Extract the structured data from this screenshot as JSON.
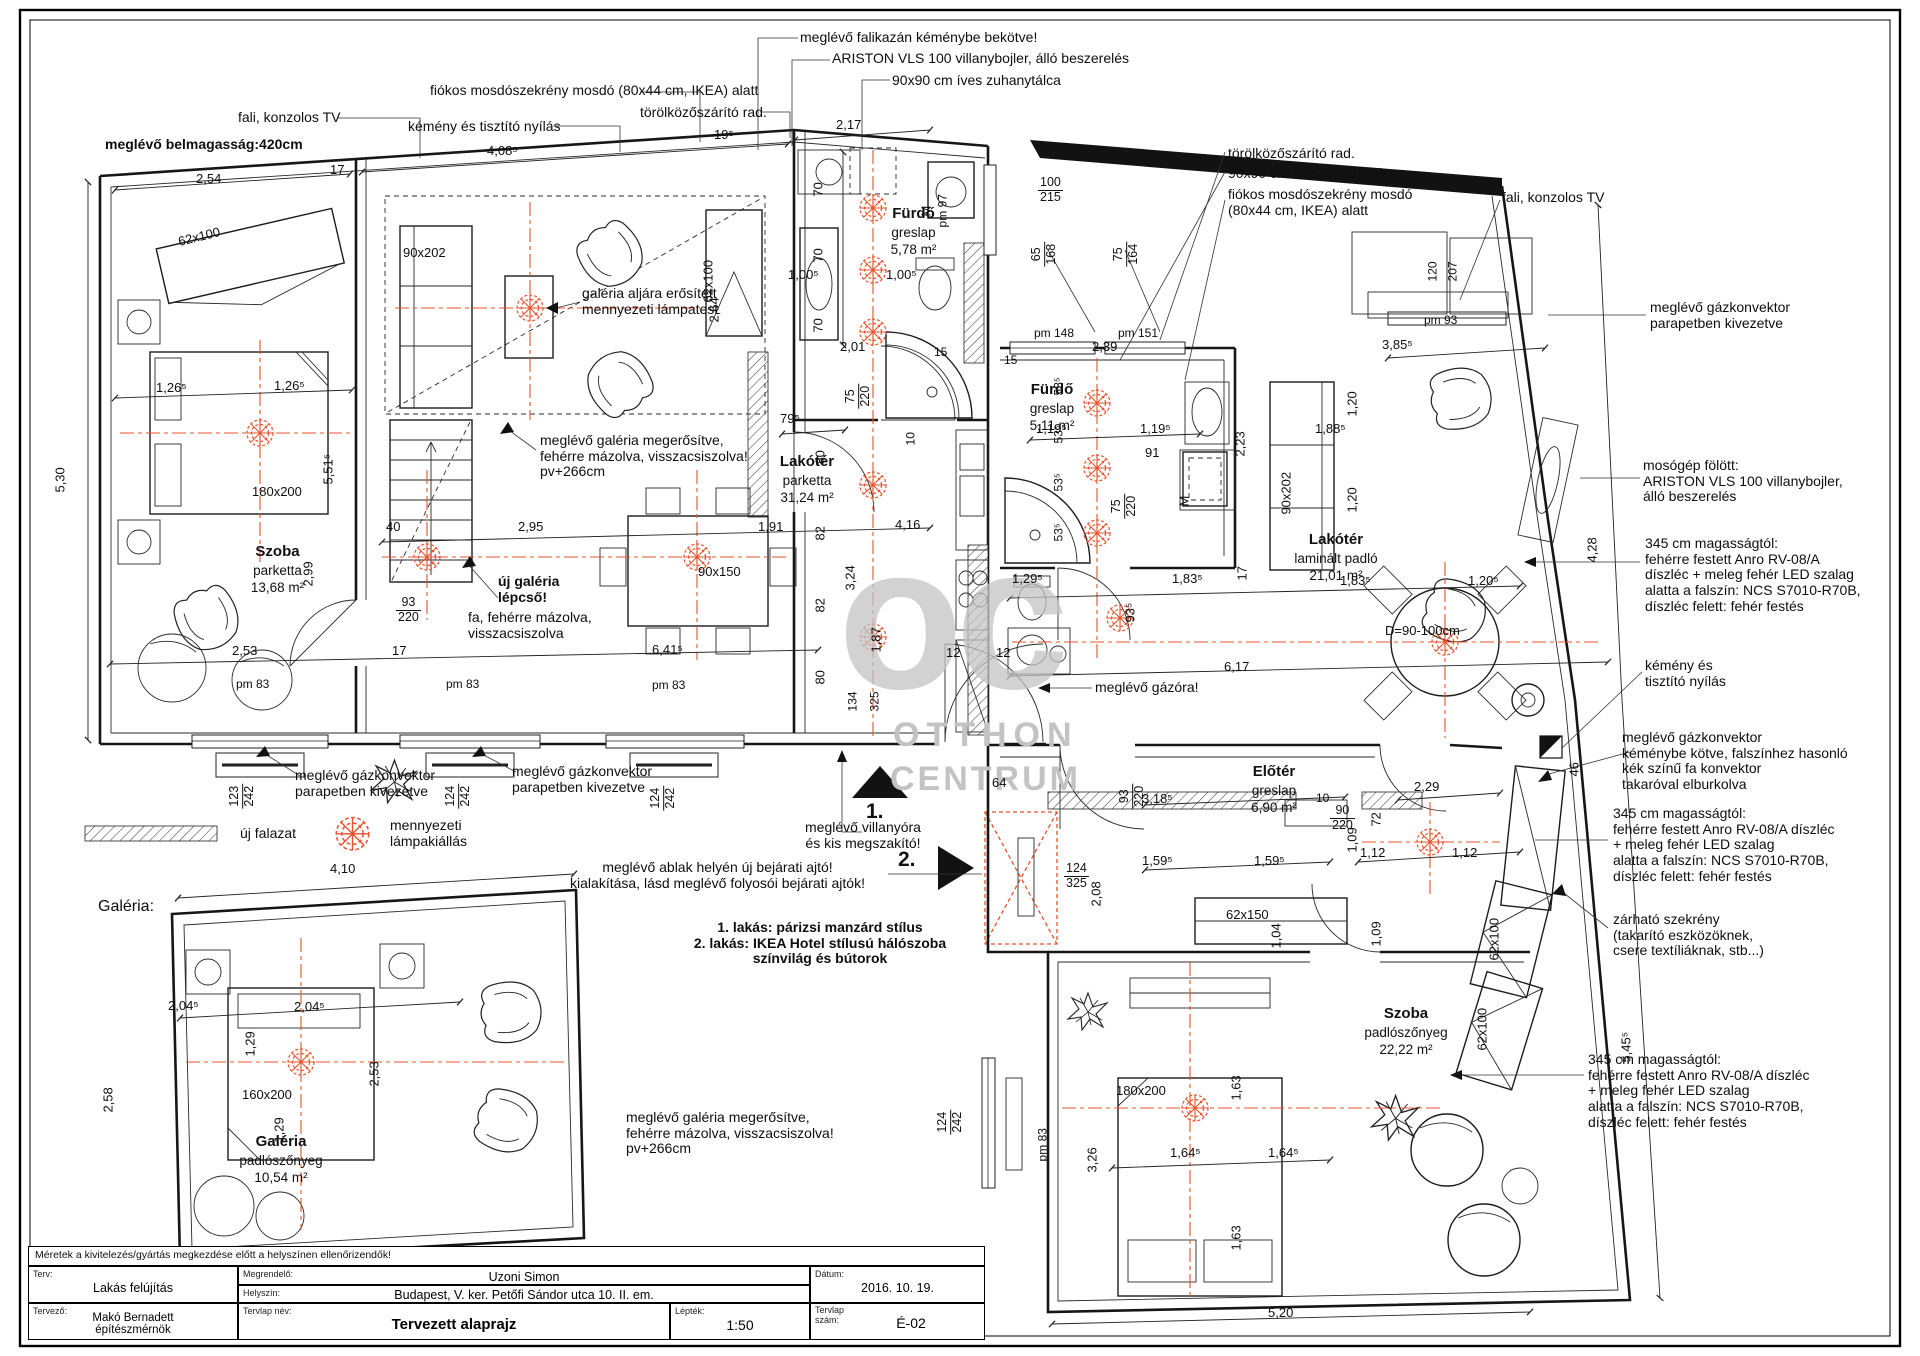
{
  "header": {
    "belmagassag": "meglévő belmagasság:420cm"
  },
  "watermark": {
    "monogram": "oc",
    "line1": "OTTHON",
    "line2": "CENTRUM"
  },
  "colors": {
    "accent_red": "#e8512c",
    "wall_black": "#121212",
    "watermark_gray": "#c3c3c3"
  },
  "callouts_top": {
    "falikazan": "meglévő falikazán kéménybe bekötve!",
    "ariston": "ARISTON VLS 100 villanybojler, álló beszerelés",
    "zuhanytalca": "90x90 cm íves zuhanytálca",
    "mosdoszekreny": "fiókos mosdószekrény mosdó (80x44 cm, IKEA) alatt",
    "torolkozo": "törölközőszárító rad.",
    "kemeny": "kémény  és tisztító nyílás",
    "tv": "fali, konzolos TV"
  },
  "callouts_right_top": {
    "torolkozo": "törölközőszárító rad.",
    "zuhanytalca": "90x90 cm íves zuhanytálca",
    "mosdoszekreny": "fiókos mosdószekrény mosdó\n(80x44 cm, IKEA) alatt",
    "tv": "fali, konzolos TV"
  },
  "callouts_right": {
    "gazkonvektor_parapet": "meglévő gázkonvektor\nparapetben kivezetve",
    "mosogep": "mosógép fölött:\nARISTON VLS 100 villanybojler,\nálló beszerelés",
    "diszlec_1": "345 cm magasságtól:\nfehérre festett Anro RV-08/A\ndíszléc + meleg fehér LED szalag\nalatta a falszín: NCS S7010-R70B,\ndíszléc felett: fehér festés",
    "kemeny": "kémény és\ntisztító nyílás",
    "gazkonvektor_kemeny": "meglévő gázkonvektor\nkéménybe kötve, falszínhez hasonló\nkék színű fa konvektor\ntakaróval elburkolva",
    "diszlec_2": "345 cm magasságtól:\nfehérre festett Anro RV-08/A díszléc\n+ meleg fehér LED szalag\nalatta a falszín: NCS S7010-R70B,\ndíszléc felett: fehér festés",
    "szekreny": "zárható szekrény\n(takarító eszközöknek,\ncsere textíliáknak, stb...)",
    "diszlec_3": "345 cm magasságtól:\nfehérre festett Anro RV-08/A díszléc\n+ meleg fehér LED szalag\nalatta a falszín: NCS S7010-R70B,\ndíszléc felett: fehér festés"
  },
  "notes": {
    "lampatest": "galéria aljára erősített\nmennyezeti lámpatest",
    "galeria_megerositve": "meglévő galéria megerősítve,\nfehérre mázolva, visszacsiszolva!\npv+266cm",
    "uj_galeria_bold": "új galéria\nlépcső!",
    "uj_galeria_rest": "fa, fehérre mázolva,\nvisszacsiszolva",
    "gazkonvektor_1": "meglévő gázkonvektor\nparapetben kivezetve",
    "gazkonvektor_2": "meglévő gázkonvektor\nparapetben kivezetve",
    "gazora": "meglévő gázóra!",
    "villanyora": "meglévő villanyóra\nés kis megszakító!",
    "uj_bejarat": "meglévő ablak helyén új bejárati ajtó!\nkialakítása, lásd meglévő folyosói bejárati ajtók!",
    "stilusok": "1. lakás: párizsi manzárd stílus\n2. lakás: IKEA Hotel stílusú hálószoba\nszínvilág és bútorok",
    "galeria_megerositve_2": "meglévő galéria megerősítve,\nfehérre mázolva, visszacsiszolva!\npv+266cm",
    "marker_1": "1.",
    "marker_2": "2.",
    "galeria_cim": "Galéria:",
    "ellenorzes": "Méretek a kivitelezés/gyártás megkezdése előtt a helyszínen ellenőrizendők!"
  },
  "legend": {
    "uj_falazat": "új falazat",
    "lampa": "mennyezeti\nlámpakiállás"
  },
  "rooms": {
    "szoba1": {
      "name": "Szoba",
      "floor": "parketta",
      "area": "13,68 m²"
    },
    "furdo1": {
      "name": "Fürdő",
      "floor": "greslap",
      "area": "5,78 m²"
    },
    "lakoter1": {
      "name": "Lakótér",
      "floor": "parketta",
      "area": "31,24 m²"
    },
    "furdo2": {
      "name": "Fürdő",
      "floor": "greslap",
      "area": "5,11 m²"
    },
    "lakoter2": {
      "name": "Lakótér",
      "floor": "laminált padló",
      "area": "21,01 m²"
    },
    "eloter": {
      "name": "Előtér",
      "floor": "greslap",
      "area": "6,90 m²"
    },
    "szoba2": {
      "name": "Szoba",
      "floor": "padlószőnyeg",
      "area": "22,22 m²"
    },
    "galeria": {
      "name": "Galéria",
      "floor": "padlószőnyeg",
      "area": "10,54 m²"
    }
  },
  "furniture": {
    "gardrob1": "62x100",
    "kanape": "90x202",
    "gardrob2": "62x100",
    "agy1": "180x200",
    "asztal": "90x150",
    "mosogep1": "M",
    "mosogep2": "M",
    "kanape2": "90x202",
    "cipos": "62x150",
    "gardrob3": "62x100",
    "gardrob4": "62x100",
    "agy2": "180x200",
    "agy3": "160x200",
    "kerek_asztal": "D=90-100cm"
  },
  "dims": {
    "d01": "2,54",
    "d02": "17",
    "d03": "4,08⁵",
    "d04": "19⁵",
    "d05": "2,17",
    "d06": "5,30",
    "d07": "1,26⁵",
    "d08": "1,26⁵",
    "d09": "5,51⁵",
    "d10": "2,99",
    "d11": "40",
    "d12": "2,95",
    "d13": "1,91",
    "d14": "4,16",
    "d15": "2,53",
    "d16": "17",
    "d17": "6,41⁵",
    "d18": "pm 83",
    "d19": "pm 83",
    "d20": "pm 83",
    "d21a": "123",
    "d21b": "242",
    "d22a": "124",
    "d22b": "242",
    "d23a": "124",
    "d23b": "242",
    "d24a": "93",
    "d24b": "220",
    "d25": "79⁵",
    "d26": "80",
    "d27": "82",
    "d28": "3,24",
    "d29": "82",
    "d30": "1,87",
    "d31": "134",
    "d32": "325",
    "d33": "80",
    "d34": "12",
    "d35": "12",
    "d36": "70",
    "d37": "70",
    "d38": "70",
    "d39": "1,00⁵",
    "d40": "1,00⁵",
    "d41": "2,01",
    "d42a": "75",
    "d42b": "220",
    "d43": "10",
    "d44": "15",
    "d45": "15",
    "d47": "pm 97",
    "d48a": "100",
    "d48b": "215",
    "d49a": "65",
    "d49b": "168",
    "d50a": "75",
    "d50b": "164",
    "d51": "pm 148",
    "d52": "pm 151",
    "d53": "2,39",
    "d54": "53⁵",
    "d55": "53⁵",
    "d56": "53⁵",
    "d57": "53⁵",
    "d58": "1,19⁵",
    "d58b": "1,19⁵",
    "d59": "1,88⁵",
    "d60": "91",
    "d61a": "75",
    "d61b": "220",
    "d62": "pm 93",
    "d63": "120",
    "d64": "207",
    "d65": "3,85⁵",
    "d66": "1,20",
    "d67": "1,20",
    "d68": "2,23",
    "d69": "17",
    "d71": "1,29⁵",
    "d72": "93⁵",
    "d73": "1,83⁵",
    "d74": "1,83⁵",
    "d75": "1,20⁵",
    "d76": "6,17",
    "d77": "4,28",
    "d78": "46",
    "d79": "5,45⁵",
    "d80": "64",
    "d81": "2,08",
    "d82": "3,18⁵",
    "d83a": "93",
    "d83b": "220",
    "d84": "10",
    "d85a": "90",
    "d85b": "220",
    "d86": "72",
    "d87": "1,09",
    "d88": "2,29",
    "d89": "1,59⁵",
    "d90": "1,59⁵",
    "d91a": "124",
    "d91b": "325",
    "d92": "1,12",
    "d93": "1,12",
    "d94": "1,09",
    "d95": "1,04",
    "d96": "3,26",
    "d97": "1,63",
    "d98": "1,63",
    "d99": "1,64⁵",
    "d100": "1,64⁵",
    "d101a": "124",
    "d101b": "242",
    "d102": "pm 83",
    "d103": "5,20",
    "d104": "4,10",
    "d105": "2,04⁵",
    "d106": "1,29",
    "d107": "2,04⁵",
    "d108": "2,58",
    "d109": "2,53",
    "d110": "1,29",
    "d111": "2,64"
  },
  "title_block": {
    "terv_label": "Terv:",
    "terv": "Lakás felújítás",
    "tervezo_label": "Tervező:",
    "tervezo": "Makó Bernadett\népítészmérnök",
    "megrendelo_label": "Megrendelő:",
    "megrendelo": "Uzoni Simon",
    "helyszin_label": "Helyszín:",
    "helyszin": "Budapest, V. ker. Petőfi Sándor utca 10. II. em.",
    "datum_label": "Dátum:",
    "datum": "2016. 10. 19.",
    "tervlap_nev_label": "Tervlap név:",
    "tervlap_nev": "Tervezett alaprajz",
    "leptek_label": "Lépték:",
    "leptek": "1:50",
    "tervlap_szam_label": "Tervlap\nszám:",
    "tervlap_szam": "É-02"
  }
}
